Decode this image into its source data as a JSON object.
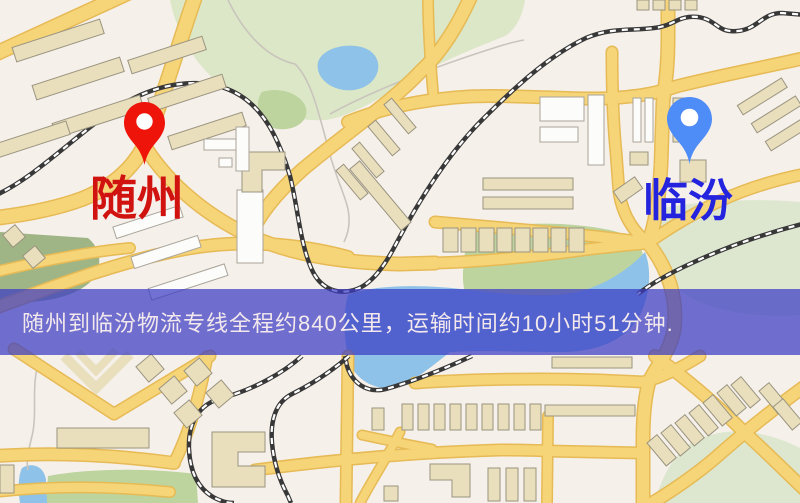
{
  "banner": {
    "text": "随州到临汾物流专线全程约840公里，运输时间约10小时51分钟.",
    "bg_rgba": "rgba(58,60,195,0.72)",
    "text_color": "#f3e9ec"
  },
  "route": {
    "origin_label": "随州",
    "destination_label": "临汾",
    "distance_text": "840公里",
    "duration_text": "10小时51分钟"
  },
  "markers": {
    "origin": {
      "label": "随州",
      "label_color": "#d11310",
      "pin_color": "#ee1409",
      "pin_icon": "red-map-pin"
    },
    "destination": {
      "label": "临汾",
      "label_color": "#2423dd",
      "pin_color": "#4e8cf7",
      "pin_icon": "blue-map-pin"
    }
  },
  "map": {
    "colors": {
      "bg": "#f6f0ea",
      "road": "#f6d478",
      "roadedge": "#e6ba55",
      "rail": "#383838",
      "water": "#8ec2e8",
      "park": "#dbe7c6",
      "parkdk": "#9fb585",
      "parkmd": "#bdd49e",
      "parklt": "#dde7cf",
      "btan": "#e9dfbd"
    }
  }
}
